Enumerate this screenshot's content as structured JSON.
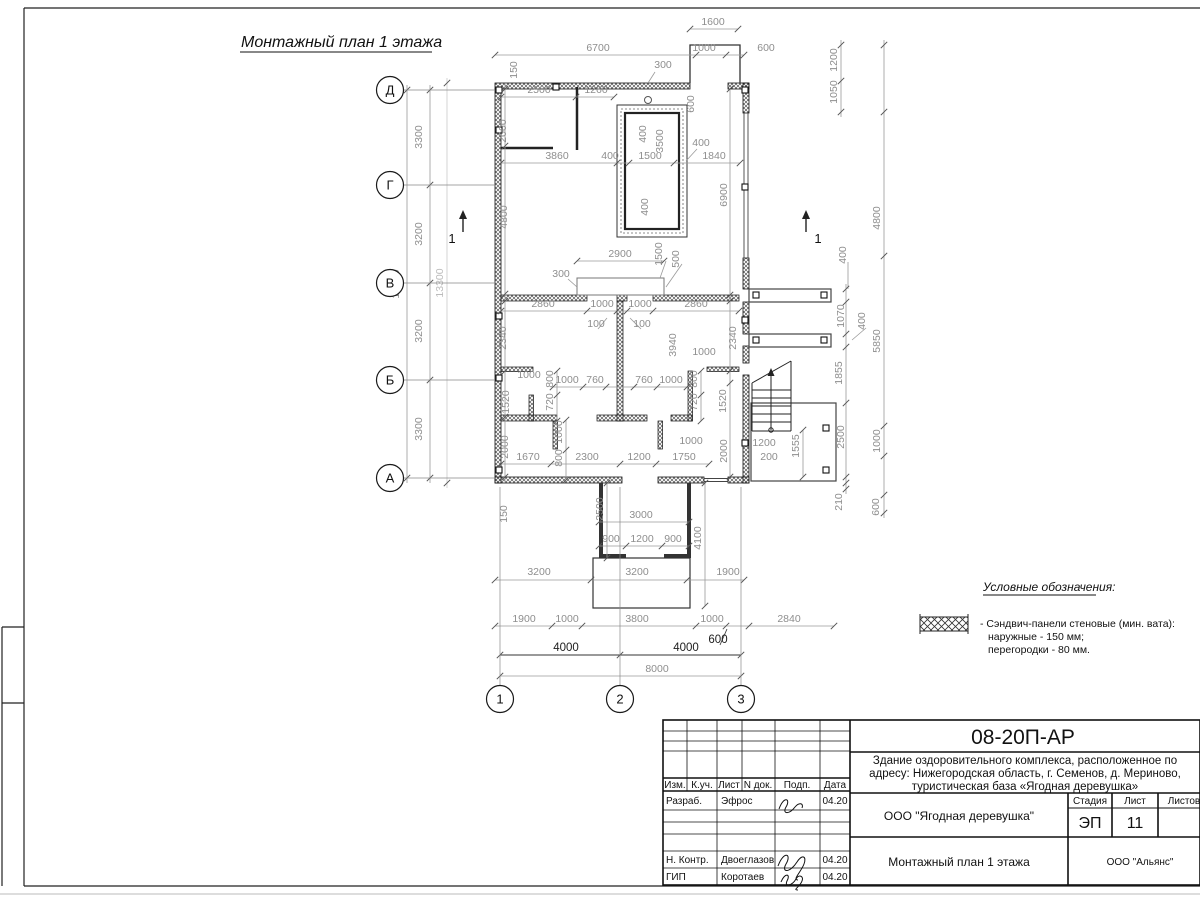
{
  "sheet": {
    "title": "Монтажный план 1 этажа"
  },
  "legend": {
    "heading": "Условные обозначения:",
    "item_line1": "- Сэндвич-панели стеновые (мин. вата):",
    "item_line2": "наружные - 150 мм;",
    "item_line3": "перегородки - 80 мм."
  },
  "axes": {
    "rows": [
      {
        "label": "Д",
        "y": 90
      },
      {
        "label": "Г",
        "y": 185
      },
      {
        "label": "В",
        "y": 283
      },
      {
        "label": "Б",
        "y": 380
      },
      {
        "label": "А",
        "y": 478
      }
    ],
    "cols": [
      {
        "label": "1",
        "x": 500
      },
      {
        "label": "2",
        "x": 620
      },
      {
        "label": "3",
        "x": 741
      }
    ]
  },
  "section_marks": [
    {
      "x": 463,
      "y": 232,
      "label": "1",
      "lx": 452,
      "ly": 243
    },
    {
      "x": 806,
      "y": 232,
      "label": "1",
      "lx": 818,
      "ly": 243
    }
  ],
  "dims": [
    [
      713,
      25,
      "1600",
      0,
      0
    ],
    [
      598,
      51,
      "6700",
      0,
      0
    ],
    [
      704,
      51,
      "1000",
      0,
      0
    ],
    [
      766,
      51,
      "600",
      0,
      0
    ],
    [
      663,
      68,
      "300",
      0,
      0
    ],
    [
      517,
      70,
      "150",
      1,
      0
    ],
    [
      539,
      93,
      "2500",
      0,
      0
    ],
    [
      596,
      93,
      "1260",
      0,
      0
    ],
    [
      506,
      131,
      "2000",
      1,
      0
    ],
    [
      694,
      104,
      "600",
      1,
      0
    ],
    [
      646,
      134,
      "400",
      1,
      0
    ],
    [
      663,
      141,
      "3500",
      1,
      0
    ],
    [
      557,
      159,
      "3860",
      0,
      0
    ],
    [
      610,
      159,
      "400",
      0,
      0
    ],
    [
      650,
      159,
      "1500",
      0,
      0
    ],
    [
      701,
      146,
      "400",
      0,
      0
    ],
    [
      714,
      159,
      "1840",
      0,
      0
    ],
    [
      507,
      217,
      "4800",
      1,
      0
    ],
    [
      727,
      195,
      "6900",
      1,
      0
    ],
    [
      648,
      207,
      "400",
      1,
      0
    ],
    [
      620,
      257,
      "2900",
      0,
      0
    ],
    [
      662,
      254,
      "1500",
      1,
      0
    ],
    [
      679,
      259,
      "500",
      1,
      0
    ],
    [
      561,
      277,
      "300",
      0,
      0
    ],
    [
      543,
      307,
      "2860",
      0,
      0
    ],
    [
      602,
      307,
      "1000",
      0,
      0
    ],
    [
      640,
      307,
      "1000",
      0,
      0
    ],
    [
      696,
      307,
      "2860",
      0,
      0
    ],
    [
      596,
      327,
      "100",
      0,
      0
    ],
    [
      642,
      327,
      "100",
      0,
      0
    ],
    [
      506,
      338,
      "2340",
      1,
      0
    ],
    [
      736,
      338,
      "2340",
      1,
      0
    ],
    [
      676,
      345,
      "3940",
      1,
      0
    ],
    [
      704,
      355,
      "1000",
      0,
      0
    ],
    [
      529,
      378,
      "1000",
      0,
      0
    ],
    [
      553,
      379,
      "800",
      1,
      0
    ],
    [
      553,
      402,
      "720",
      1,
      0
    ],
    [
      509,
      402,
      "1520",
      1,
      0
    ],
    [
      567,
      383,
      "1000",
      0,
      0
    ],
    [
      595,
      383,
      "760",
      0,
      0
    ],
    [
      644,
      383,
      "760",
      0,
      0
    ],
    [
      671,
      383,
      "1000",
      0,
      0
    ],
    [
      697,
      379,
      "800",
      1,
      0
    ],
    [
      697,
      402,
      "720",
      1,
      0
    ],
    [
      726,
      401,
      "1520",
      1,
      0
    ],
    [
      562,
      432,
      "1000",
      1,
      0
    ],
    [
      562,
      458,
      "800",
      1,
      0
    ],
    [
      508,
      447,
      "2000",
      1,
      0
    ],
    [
      528,
      460,
      "1670",
      0,
      0
    ],
    [
      587,
      460,
      "2300",
      0,
      0
    ],
    [
      639,
      460,
      "1200",
      0,
      0
    ],
    [
      684,
      460,
      "1750",
      0,
      0
    ],
    [
      691,
      444,
      "1000",
      0,
      0
    ],
    [
      727,
      451,
      "2000",
      1,
      0
    ],
    [
      764,
      446,
      "1200",
      0,
      0
    ],
    [
      769,
      460,
      "200",
      0,
      0
    ],
    [
      799,
      446,
      "1555",
      1,
      0
    ],
    [
      507,
      514,
      "150",
      1,
      0
    ],
    [
      603,
      509,
      "2500",
      1,
      0
    ],
    [
      641,
      518,
      "3000",
      0,
      0
    ],
    [
      611,
      542,
      "900",
      0,
      0
    ],
    [
      642,
      542,
      "1200",
      0,
      0
    ],
    [
      673,
      542,
      "900",
      0,
      0
    ],
    [
      701,
      538,
      "4100",
      1,
      0
    ],
    [
      539,
      575,
      "3200",
      0,
      0
    ],
    [
      637,
      575,
      "3200",
      0,
      0
    ],
    [
      728,
      575,
      "1900",
      0,
      0
    ],
    [
      524,
      622,
      "1900",
      0,
      0
    ],
    [
      567,
      622,
      "1000",
      0,
      0
    ],
    [
      637,
      622,
      "3800",
      0,
      0
    ],
    [
      712,
      622,
      "1000",
      0,
      0
    ],
    [
      789,
      622,
      "2840",
      0,
      0
    ],
    [
      718,
      643,
      "600",
      0,
      1
    ],
    [
      566,
      651,
      "4000",
      0,
      1
    ],
    [
      686,
      651,
      "4000",
      0,
      1
    ],
    [
      657,
      672,
      "8000",
      0,
      0
    ],
    [
      837,
      60,
      "1200",
      1,
      0
    ],
    [
      837,
      92,
      "1050",
      1,
      0
    ],
    [
      880,
      218,
      "4800",
      1,
      0
    ],
    [
      880,
      341,
      "5850",
      1,
      0
    ],
    [
      880,
      441,
      "1000",
      1,
      0
    ],
    [
      879,
      507,
      "600",
      1,
      0
    ],
    [
      846,
      255,
      "400",
      1,
      0
    ],
    [
      844,
      316,
      "1070",
      1,
      0
    ],
    [
      865,
      321,
      "400",
      1,
      0
    ],
    [
      842,
      373,
      "1855",
      1,
      0
    ],
    [
      844,
      437,
      "2500",
      1,
      0
    ],
    [
      842,
      502,
      "210",
      1,
      0
    ],
    [
      422,
      137,
      "3300",
      1,
      0
    ],
    [
      422,
      234,
      "3200",
      1,
      0
    ],
    [
      422,
      331,
      "3200",
      1,
      0
    ],
    [
      422,
      429,
      "3300",
      1,
      0
    ],
    [
      399,
      284,
      "13000",
      1,
      0
    ],
    [
      443,
      283,
      "13300",
      1,
      2
    ]
  ],
  "title_block": {
    "doc_code": "08-20П-АР",
    "project_line1": "Здание оздоровительного комплекса, расположенное по",
    "project_line2": "адресу: Нижегородская область, г. Семенов, д. Мериново,",
    "project_line3": "туристическая база «Ягодная деревушка»",
    "company": "ООО \"Ягодная деревушка\"",
    "drawing_title": "Монтажный план 1 этажа",
    "contractor": "ООО \"Альянс\"",
    "stage_label": "Стадия",
    "sheet_label": "Лист",
    "sheets_label": "Листов",
    "stage": "ЭП",
    "sheet_no": "11",
    "cols": [
      "Изм.",
      "К.уч.",
      "Лист",
      "N док.",
      "Подп.",
      "Дата"
    ],
    "rows": [
      {
        "role": "Разраб.",
        "name": "Эфрос",
        "date": "04.20"
      },
      {
        "role": "Н. Контр.",
        "name": "Двоеглазов",
        "date": "04.20"
      },
      {
        "role": "ГИП",
        "name": "Коротаев",
        "date": "04.20"
      }
    ]
  }
}
